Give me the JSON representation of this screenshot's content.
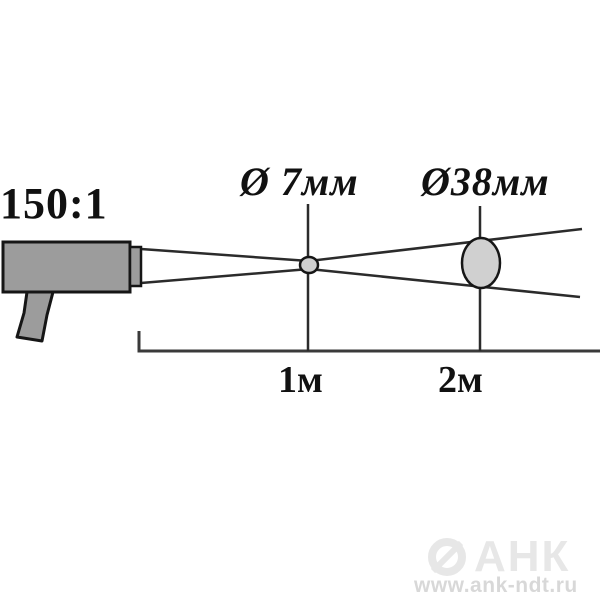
{
  "diagram": {
    "type": "optical-resolution-diagram",
    "optics_ratio_label": "150:1",
    "spots": [
      {
        "distance_label": "1м",
        "diameter_label": "Ø 7мм"
      },
      {
        "distance_label": "2м",
        "diameter_label": "Ø38мм"
      }
    ],
    "device": "infrared-pyrometer"
  },
  "watermark": {
    "brand": "АНК",
    "url": "www.ank-ndt.ru"
  },
  "colors": {
    "background": "#ffffff",
    "device_fill": "#9c9c9c",
    "spot_fill": "#d0d0d0",
    "outline": "#161616",
    "beam_line": "#2b2b2b",
    "watermark_brand": "#e7e7e7",
    "watermark_url": "#d8d8d8"
  }
}
